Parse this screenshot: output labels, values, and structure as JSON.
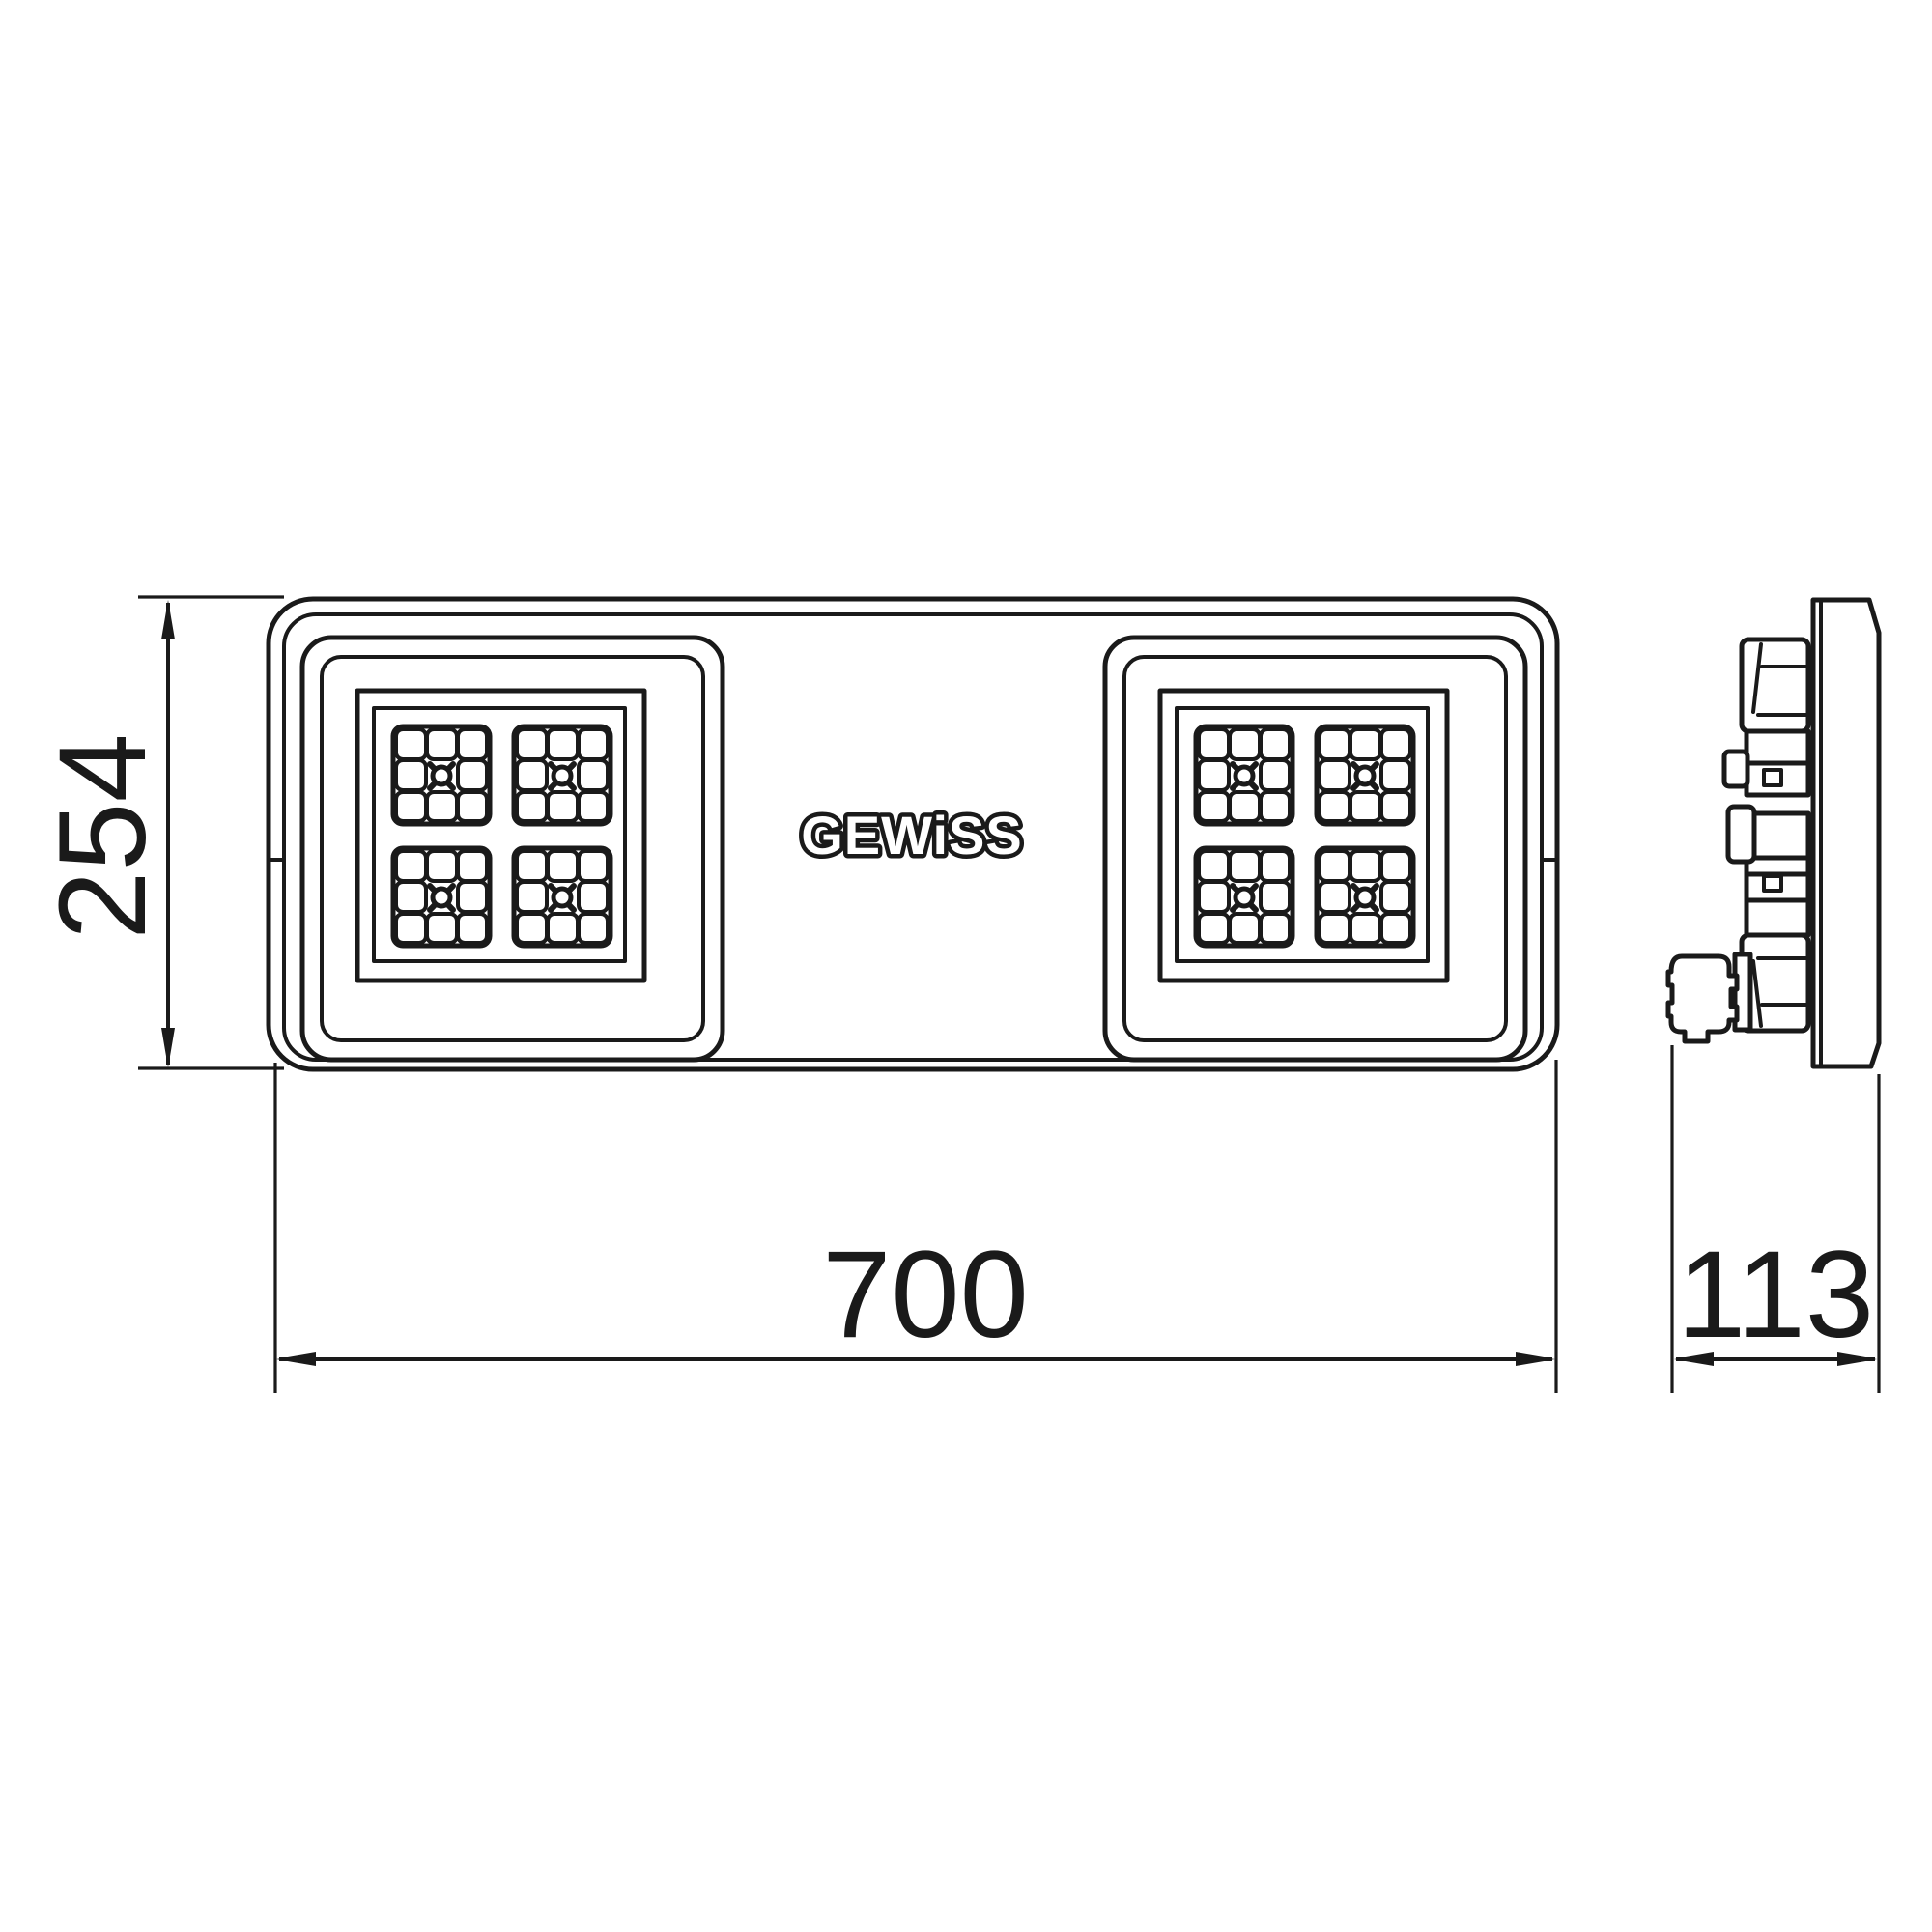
{
  "logo": {
    "text": "GEWiSS"
  },
  "dimensions": {
    "height": "254",
    "width": "700",
    "depth": "113"
  },
  "colors": {
    "line": "#1a1a1a",
    "background": "#ffffff"
  }
}
